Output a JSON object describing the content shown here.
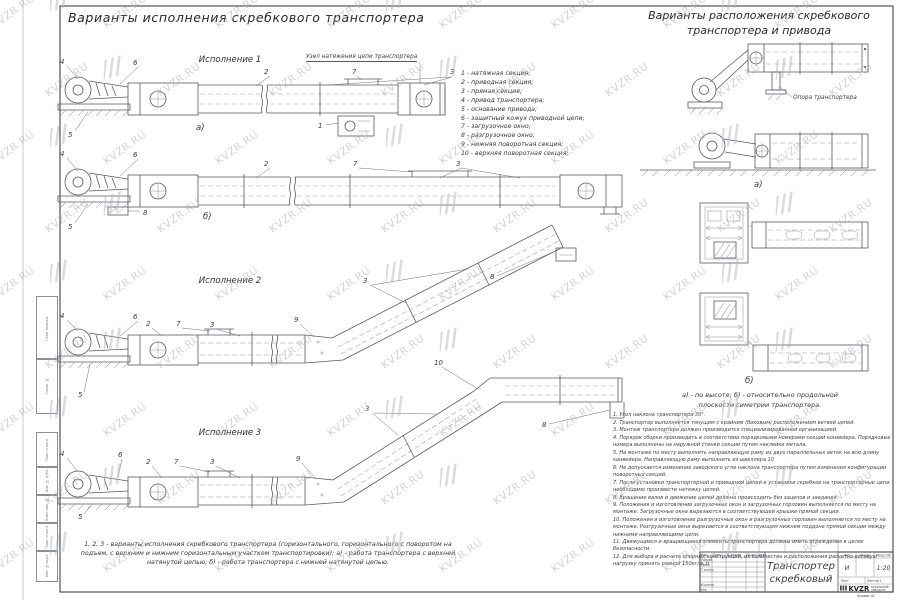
{
  "watermark": {
    "text": "KVZR.RU"
  },
  "margin_labels": [
    "Перв. примен.",
    "Справ. №",
    "Подп. и дата",
    "Инв. № дубл.",
    "Взам. инв. №",
    "Подп. и дата",
    "Инв. № подл."
  ],
  "left": {
    "title": "Варианты исполнения скребкового транспортера",
    "exec1": "Исполнение  1",
    "exec2": "Исполнение  2",
    "exec3": "Исполнение  3",
    "tension_label": "Узел натяжения цепи транспортера",
    "caption": "1, 2, 3 - варианты исполнения скребкового транспортера (горизонтального, горизонтального с поворотом на подъем, с верхним и нижним горизонтальным участком транспортировки); а) - работа транспортера с верхней натянутой цепью; б) -  работа транспортера с нижней натянутой цепью."
  },
  "labels": {
    "a": "а)",
    "b": "б)"
  },
  "co": {
    "n1": "1",
    "n2": "2",
    "n3": "3",
    "n4": "4",
    "n5": "5",
    "n6": "6",
    "n7": "7",
    "n8": "8",
    "n9": "9",
    "n10": "10"
  },
  "legend": [
    "1 -  натяжная секция;",
    "2 -  приводная секция;",
    "3 -  прямая секция;",
    "4 -  привод транспортера;",
    "5 -  основание привода;",
    "6 -  защитный кожух приводной цепи;",
    "7 -  загрузочное окно;",
    "8 -  разгрузочное окно;",
    "9 -  нижняя поворотная секция;",
    "10 -  верхняя поворотная секция;"
  ],
  "right": {
    "title1": "Варианты расположения скребкового",
    "title2": "транспортера и привода",
    "support_label": "Опора транспортера",
    "caption1": "а) -  по высоте;  б) -  относительно продольной",
    "caption2": "плоскости симетрии транспортера."
  },
  "notes": [
    "1. Угол наклона транспортера  30°.",
    "2. Транспортер выполняется тянущим с крайним (боковым) расположением ветвей цепей.",
    "3. Монтаж транспортера должен производится специализированной организацией.",
    "4. Порядок сборки производить в соответствии порядковыми номерами секций конвейера. Порядковые номера выполнены на наружной стенки секции путем наклейки метала.",
    "5. На монтаже по месту выполнить направляющую раму из двух параллельных веток на всю длину конвейера. Направляющую раму выполнить из швеллера 10",
    "6. Не допускается изменение заводского угла наклона транспортера путем изменения конфигурации поворотных секций.",
    "7. После установки транспортерной и приводной цепей и установки скребков на транспортерные цепи необходимо произвести натяжку цепей.",
    "8. Вращение валов и движение цепей должно происходить без зацепов и заедания.",
    "9. Положения и изготовление загрузочных окон и загрузочных горловин выполняется по месту на монтаже. Загрузочные окна вырезаются в соответствующей крышке прямой секции.",
    "10. Положения и изготовление разгрузочных окон и разгрузочных горловин выполняется по месту на монтаже. Разгрузочные окна вырезаются в соответствующем нижнем поддоне прямой секции между нижними направляющими цепи.",
    "11. Движущиеся и вращающиеся элементы транспортера должны иметь ограждения в целях безопасности.",
    "12. Для выбора и расчета опорных конструкций, их количества и расположения расчетно-весовую нагрузку принять равной  150кг/м. п."
  ],
  "stamp": {
    "cols": [
      "Изм.",
      "Лист",
      "N докум.",
      "Подп.",
      "Дата"
    ],
    "rows": [
      "Разраб.",
      "Пров.",
      "Т.контр.",
      "",
      "",
      "Н.контр.",
      "Утв."
    ],
    "title1": "Транспортер",
    "title2": "скребковый",
    "lit": "Лит.",
    "mass": "Масса",
    "scale": "Масштаб",
    "lit_v": "И",
    "scale_v": "1:20",
    "sheet": "Лист",
    "sheets": "Листов  1",
    "logo": "KVZR",
    "logo1": "КОТЕЛЬНЫЙ",
    "logo2": "ЗАВОД.РФ",
    "format": "Формат А1"
  }
}
